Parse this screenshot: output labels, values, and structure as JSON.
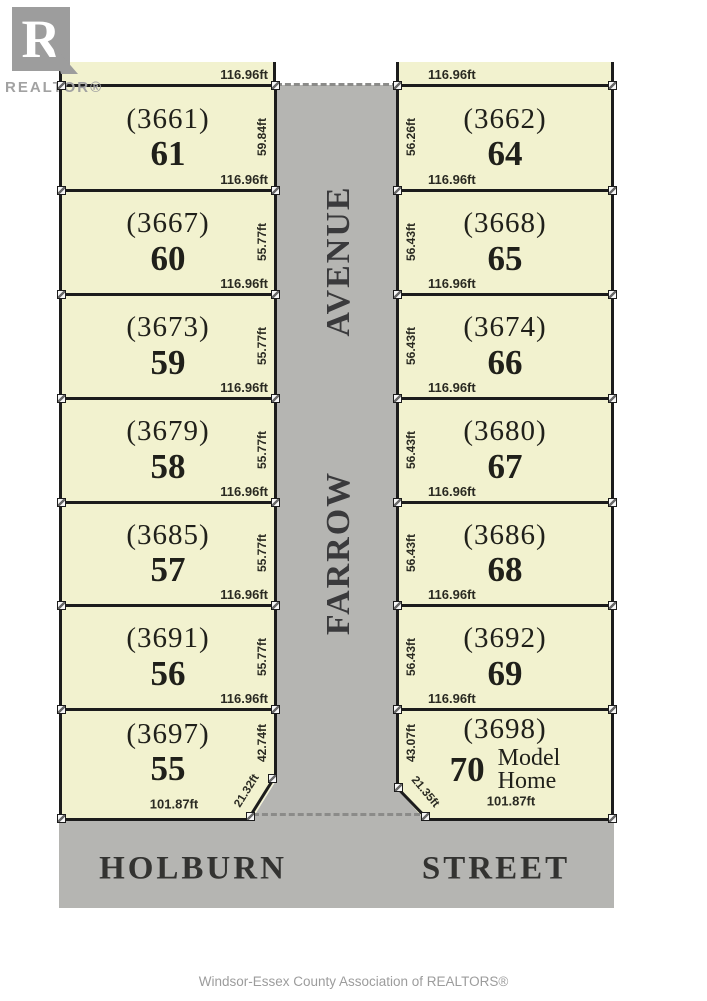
{
  "branding": {
    "logo_letter": "R",
    "logo_wordmark": "REALTOR®"
  },
  "footer": {
    "credit": "Windsor-Essex County Association of REALTORS®"
  },
  "streets": {
    "avenue_word": "AVENUE",
    "farrow_word": "FARROW",
    "holburn_word": "HOLBURN",
    "street_word": "STREET"
  },
  "colors": {
    "lot_fill": "#f2f2cf",
    "pavement_gray": "#b5b5b2",
    "line_black": "#1c1c1c",
    "logo_gray": "#9d9d9d"
  },
  "lots": {
    "left": [
      {
        "plan": "(3661)",
        "number": "61",
        "frontage": "116.96ft",
        "depth": "59.84ft"
      },
      {
        "plan": "(3667)",
        "number": "60",
        "frontage": "116.96ft",
        "depth": "55.77ft"
      },
      {
        "plan": "(3673)",
        "number": "59",
        "frontage": "116.96ft",
        "depth": "55.77ft"
      },
      {
        "plan": "(3679)",
        "number": "58",
        "frontage": "116.96ft",
        "depth": "55.77ft"
      },
      {
        "plan": "(3685)",
        "number": "57",
        "frontage": "116.96ft",
        "depth": "55.77ft"
      },
      {
        "plan": "(3691)",
        "number": "56",
        "frontage": "116.96ft",
        "depth": "55.77ft"
      },
      {
        "plan": "(3697)",
        "number": "55",
        "frontage": "116.96ft",
        "depth": "42.74ft",
        "chamfer": "21.32ft",
        "bottom": "101.87ft"
      }
    ],
    "right": [
      {
        "plan": "(3662)",
        "number": "64",
        "frontage": "116.96ft",
        "depth": "56.26ft"
      },
      {
        "plan": "(3668)",
        "number": "65",
        "frontage": "116.96ft",
        "depth": "56.43ft"
      },
      {
        "plan": "(3674)",
        "number": "66",
        "frontage": "116.96ft",
        "depth": "56.43ft"
      },
      {
        "plan": "(3680)",
        "number": "67",
        "frontage": "116.96ft",
        "depth": "56.43ft"
      },
      {
        "plan": "(3686)",
        "number": "68",
        "frontage": "116.96ft",
        "depth": "56.43ft"
      },
      {
        "plan": "(3692)",
        "number": "69",
        "frontage": "116.96ft",
        "depth": "56.43ft"
      },
      {
        "plan": "(3698)",
        "number": "70",
        "frontage": "116.96ft",
        "depth": "43.07ft",
        "chamfer": "21.35ft",
        "bottom": "101.87ft",
        "note_line1": "Model",
        "note_line2": "Home"
      }
    ]
  }
}
